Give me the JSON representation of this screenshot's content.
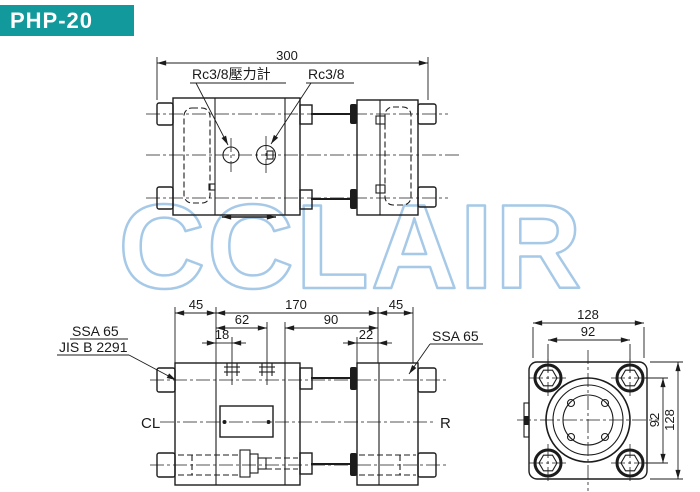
{
  "header": {
    "model": "PHP-20",
    "bg_color": "#12999b"
  },
  "watermark": {
    "text": "CCLAIR",
    "color": "#a6c9e8"
  },
  "top_view": {
    "dim_overall_width": "300",
    "label_pressure_gauge_port": "Rc3/8壓力計",
    "label_port": "Rc3/8"
  },
  "front_view": {
    "dim_left_flange": "45",
    "dim_body_length": "170",
    "dim_right_flange": "45",
    "dim_port_span": "62",
    "dim_right_section": "90",
    "dim_port_offset_left": "18",
    "dim_port_offset_right": "22",
    "label_flange_spec_left": "SSA 65",
    "label_flange_standard_left": "JIS B 2291",
    "label_flange_spec_right": "SSA 65",
    "label_centerline": "CL",
    "label_right_port": "R"
  },
  "side_view": {
    "dim_width": "128",
    "dim_bolt_spacing_h": "92",
    "dim_bolt_spacing_v": "92",
    "dim_height": "128"
  }
}
